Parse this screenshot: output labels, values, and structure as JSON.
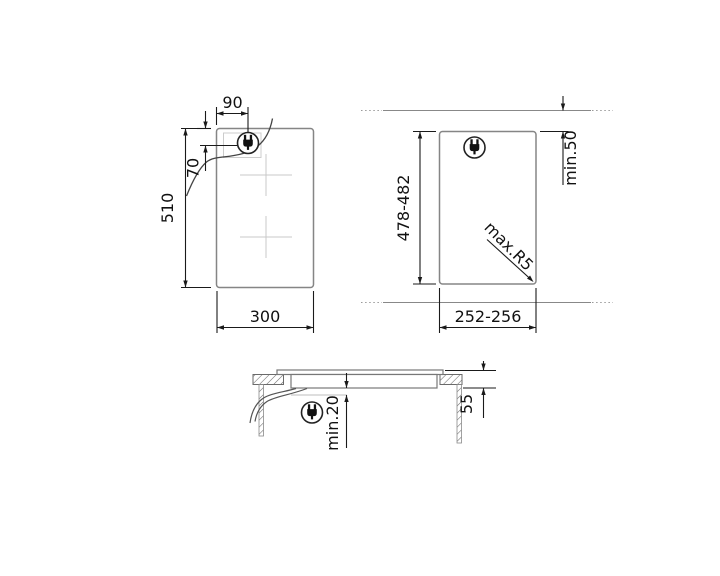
{
  "colors": {
    "dimension_line": "#1a1a1a",
    "object_outline": "#858585",
    "faint_guide": "#cccccc",
    "background": "#ffffff"
  },
  "views": {
    "top_view": {
      "plug_offset_x": "90",
      "plug_offset_y": "70",
      "height": "510",
      "width": "300"
    },
    "cutout_view": {
      "cutout_height": "478-482",
      "rear_clearance": "min.50",
      "corner_radius": "max.R5",
      "cutout_width": "252-256"
    },
    "side_view": {
      "bottom_clearance": "min.20",
      "built_in_depth": "55"
    }
  },
  "icons": {
    "power_plug": "power-plug-icon"
  }
}
